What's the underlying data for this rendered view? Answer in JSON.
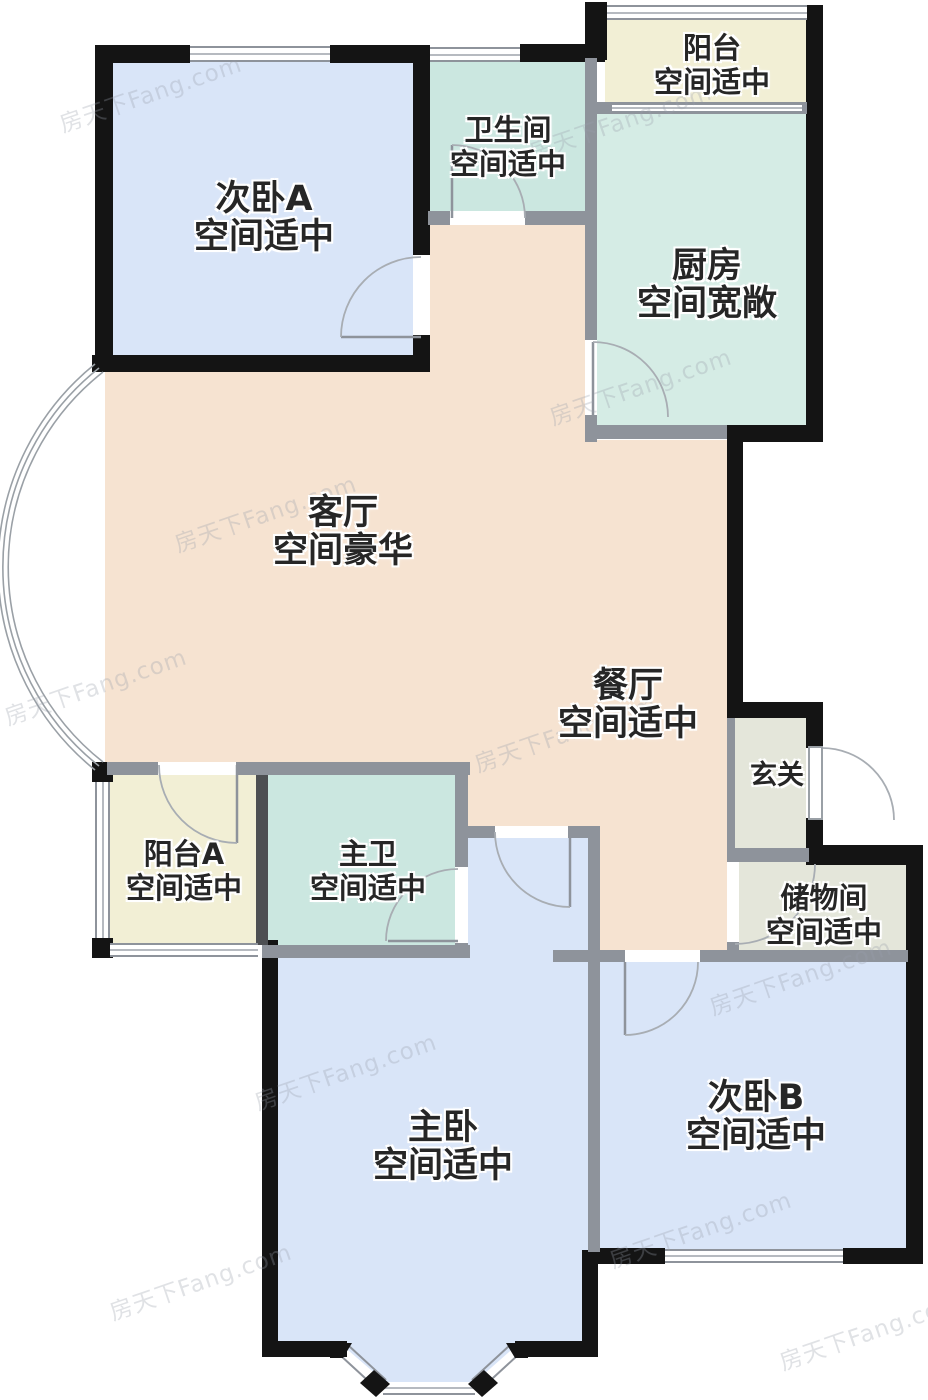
{
  "watermark": {
    "text": "房天下Fang.com"
  },
  "rooms": {
    "bedroomA": {
      "name": "次卧A",
      "note": "空间适中"
    },
    "bathroom": {
      "name": "卫生间",
      "note": "空间适中"
    },
    "balcony": {
      "name": "阳台",
      "note": "空间适中"
    },
    "kitchen": {
      "name": "厨房",
      "note": "空间宽敞"
    },
    "living": {
      "name": "客厅",
      "note": "空间豪华"
    },
    "dining": {
      "name": "餐厅",
      "note": "空间适中"
    },
    "entry": {
      "name": "玄关"
    },
    "balconyA": {
      "name": "阳台A",
      "note": "空间适中"
    },
    "masterBath": {
      "name": "主卫",
      "note": "空间适中"
    },
    "storage": {
      "name": "储物间",
      "note": "空间适中"
    },
    "masterBedroom": {
      "name": "主卧",
      "note": "空间适中"
    },
    "bedroomB": {
      "name": "次卧B",
      "note": "空间适中"
    }
  },
  "colors": {
    "blue": "#d9e5f8",
    "bath": "#cbe7e0",
    "kitchen": "#d5ece5",
    "cream": "#f2efd5",
    "peach": "#f6e3d1",
    "sage": "#e4e6da",
    "wallBlack": "#141414",
    "wallGray": "#8e939b",
    "wallDark": "#4d4f52"
  }
}
